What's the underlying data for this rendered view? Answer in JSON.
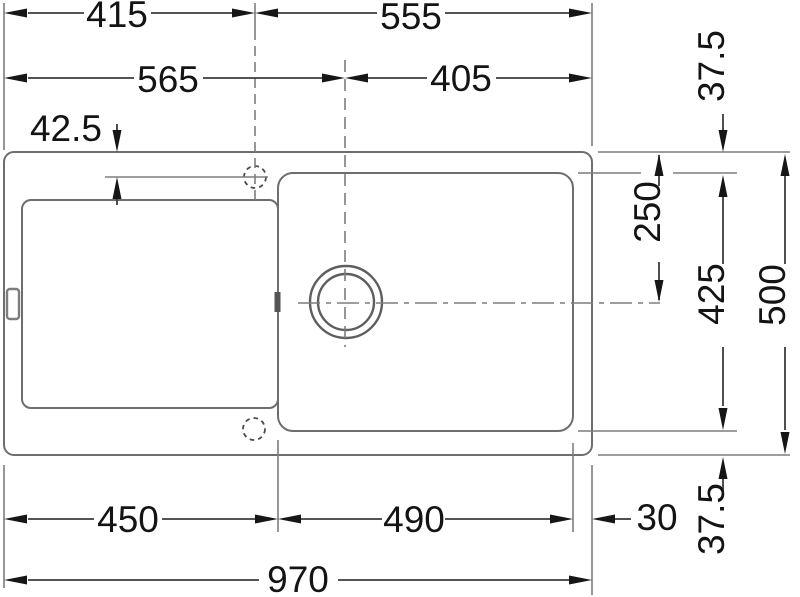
{
  "drawing": {
    "type": "sink-technical-dimension-drawing",
    "colors": {
      "outline": "#6e6e6e",
      "extension": "#7d7d7d",
      "dimension_line": "#3c3c3c",
      "arrow": "#161616",
      "text": "#141414",
      "background": "#ffffff"
    },
    "dimensions": {
      "d415": "415",
      "d555": "555",
      "d565": "565",
      "d405": "405",
      "d42_5": "42.5",
      "d37_5_top": "37.5",
      "d250": "250",
      "d425": "425",
      "d500": "500",
      "d37_5_bottom": "37.5",
      "d450": "450",
      "d490": "490",
      "d30": "30",
      "d970": "970"
    }
  }
}
